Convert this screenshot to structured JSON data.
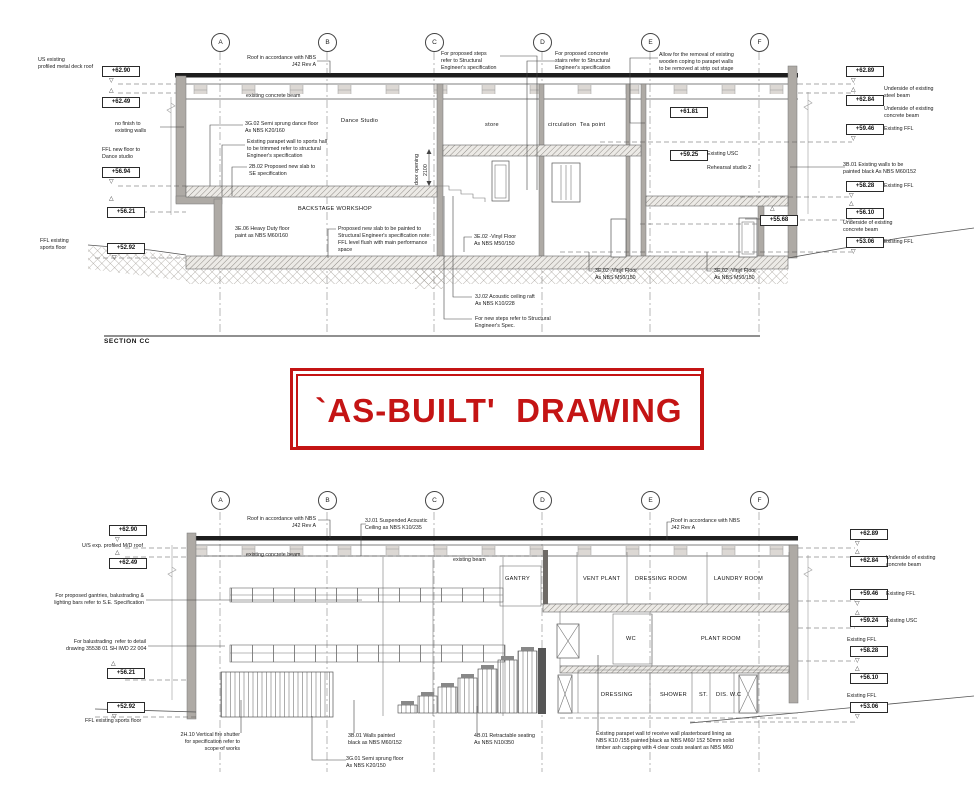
{
  "stamp": {
    "text": "`AS-BUILT'  DRAWING"
  },
  "colors": {
    "stamp_red": "#c41414",
    "line_dark": "#333333",
    "wall_gray": "#aeaaa5"
  },
  "icons": {
    "level-marker-down": "▽",
    "level-marker-up": "△"
  },
  "section_top": {
    "title": "SECTION CC",
    "grid": [
      {
        "label": "A",
        "x": 220
      },
      {
        "label": "B",
        "x": 327
      },
      {
        "label": "C",
        "x": 434
      },
      {
        "label": "D",
        "x": 542
      },
      {
        "label": "E",
        "x": 650
      },
      {
        "label": "F",
        "x": 759
      }
    ],
    "labels": [
      {
        "name": "note-us-existing-roof",
        "cls": "note",
        "text": "US existing\nprofiled metal deck roof",
        "x": 38,
        "y": 57
      },
      {
        "name": "level-box",
        "cls": "box",
        "text": "+62.90",
        "x": 102,
        "y": 66
      },
      {
        "name": "level-marker-down-icon",
        "cls": "marker",
        "text": "▽",
        "x": 109,
        "y": 78
      },
      {
        "name": "level-marker-up-icon",
        "cls": "marker",
        "text": "△",
        "x": 109,
        "y": 88
      },
      {
        "name": "level-box",
        "cls": "box",
        "text": "+62.49",
        "x": 102,
        "y": 97
      },
      {
        "name": "note-no-finish",
        "cls": "note",
        "text": "no finish to\nexisting walls",
        "x": 115,
        "y": 121
      },
      {
        "name": "note-ffl-new-floor",
        "cls": "note",
        "text": "FFL new floor to\nDance studio",
        "x": 102,
        "y": 147
      },
      {
        "name": "level-box",
        "cls": "box",
        "text": "+56.94",
        "x": 102,
        "y": 167
      },
      {
        "name": "level-marker-down-icon",
        "cls": "marker",
        "text": "▽",
        "x": 109,
        "y": 179
      },
      {
        "name": "level-marker-up-icon",
        "cls": "marker",
        "text": "△",
        "x": 109,
        "y": 196
      },
      {
        "name": "level-box",
        "cls": "box",
        "text": "+56.21",
        "x": 107,
        "y": 207
      },
      {
        "name": "note-ffl-existing-sports",
        "cls": "note",
        "text": "FFL existing\nsports floor",
        "x": 40,
        "y": 238
      },
      {
        "name": "level-box",
        "cls": "box",
        "text": "+52.92",
        "x": 107,
        "y": 243
      },
      {
        "name": "level-marker-down-icon",
        "cls": "marker",
        "text": "▽",
        "x": 112,
        "y": 255
      },
      {
        "name": "note-roof-nbs",
        "cls": "note",
        "text": "Roof in accordance with NBS\nJ42 Rev A",
        "x": 241,
        "y": 55,
        "w": 75,
        "align": "right"
      },
      {
        "name": "note-existing-concrete-beam",
        "cls": "note",
        "text": "existing concrete beam",
        "x": 246,
        "y": 93
      },
      {
        "name": "note-dance-floor-spec",
        "cls": "note",
        "text": "3G.02 Semi sprung dance floor\nAs NBS K20/160",
        "x": 245,
        "y": 121
      },
      {
        "name": "note-parapet-wall",
        "cls": "note",
        "text": "Existing parapet wall to sports hall\nto be trimmed refer to structural\nEngineer's specification",
        "x": 247,
        "y": 139
      },
      {
        "name": "note-new-slab",
        "cls": "note",
        "text": "2B.02 Proposed new slab to\nSE specification",
        "x": 249,
        "y": 164
      },
      {
        "name": "room-dance-studio",
        "cls": "room",
        "text": "Dance Studio",
        "x": 341,
        "y": 118
      },
      {
        "name": "note-proposed-steps",
        "cls": "note",
        "text": "For proposed steps\nrefer to Structural\nEngineer's specification",
        "x": 441,
        "y": 51
      },
      {
        "name": "note-proposed-stairs",
        "cls": "note",
        "text": "For proposed concrete\nstairs refer to Structural\nEngineer's specification",
        "x": 555,
        "y": 51
      },
      {
        "name": "note-wooden-coping",
        "cls": "note",
        "text": "Allow for the removal of existing\nwooden coping to parapet walls\nto be removed at strip out stage",
        "x": 659,
        "y": 52
      },
      {
        "name": "room-store",
        "cls": "room",
        "text": "store",
        "x": 485,
        "y": 122
      },
      {
        "name": "room-circulation",
        "cls": "room",
        "text": "circulation",
        "x": 548,
        "y": 122
      },
      {
        "name": "room-tea-point",
        "cls": "room",
        "text": "Tea point",
        "x": 580,
        "y": 122
      },
      {
        "name": "note-door-opening",
        "cls": "rot",
        "text": "door opening",
        "x": 414,
        "y": 185
      },
      {
        "name": "dim-door-opening",
        "cls": "rot",
        "text": "2100",
        "x": 423,
        "y": 176
      },
      {
        "name": "level-box",
        "cls": "box",
        "text": "+61.81",
        "x": 670,
        "y": 107
      },
      {
        "name": "level-box",
        "cls": "box",
        "text": "+59.25",
        "x": 670,
        "y": 150
      },
      {
        "name": "note-existing-usc",
        "cls": "note",
        "text": "Existing USC",
        "x": 707,
        "y": 151
      },
      {
        "name": "room-rehearsal-studio-2",
        "cls": "note",
        "text": "Rehearsal studio 2",
        "x": 707,
        "y": 165
      },
      {
        "name": "room-backstage-workshop",
        "cls": "room",
        "text": "BACKSTAGE WORKSHOP",
        "x": 298,
        "y": 206
      },
      {
        "name": "note-heavy-duty-floor",
        "cls": "note",
        "text": "3E.06 Heavy Duty floor\npaint as NBS M60/160",
        "x": 235,
        "y": 226
      },
      {
        "name": "note-slab-painted",
        "cls": "note",
        "text": "Proposed new slab to be painted to\nStructural Engineer's specification note:\nFFL level flush with main performance\nspace",
        "x": 338,
        "y": 226
      },
      {
        "name": "note-vinyl-floor-1",
        "cls": "note",
        "text": "3E.02 -Vinyl Floor\nAs NBS M50/150",
        "x": 474,
        "y": 234
      },
      {
        "name": "note-vinyl-floor-2",
        "cls": "note",
        "text": "3E.02 -Vinyl Floor\nAs NBS M50/150",
        "x": 595,
        "y": 268
      },
      {
        "name": "note-vinyl-floor-3",
        "cls": "note",
        "text": "3E.02 -Vinyl Floor\nAs NBS M50/150",
        "x": 714,
        "y": 268
      },
      {
        "name": "note-acoustic-raft",
        "cls": "note",
        "text": "3J.02 Acoustic ceiling raft\nAs NBS K10/228",
        "x": 475,
        "y": 294
      },
      {
        "name": "note-new-steps",
        "cls": "note",
        "text": "For new steps refer to Structural\nEngineer's Spec.",
        "x": 475,
        "y": 316
      },
      {
        "name": "section-title",
        "cls": "title",
        "text": "SECTION CC",
        "x": 104,
        "y": 338
      },
      {
        "name": "level-marker-up-icon",
        "cls": "marker",
        "text": "△",
        "x": 770,
        "y": 206
      },
      {
        "name": "level-box",
        "cls": "box",
        "text": "+55.68",
        "x": 760,
        "y": 215
      },
      {
        "name": "level-box",
        "cls": "box",
        "text": "+62.89",
        "x": 846,
        "y": 66
      },
      {
        "name": "level-marker-down-icon",
        "cls": "marker",
        "text": "▽",
        "x": 851,
        "y": 78
      },
      {
        "name": "level-marker-up-icon",
        "cls": "marker",
        "text": "△",
        "x": 851,
        "y": 87
      },
      {
        "name": "level-box",
        "cls": "box",
        "text": "+62.84",
        "x": 846,
        "y": 95
      },
      {
        "name": "note-underside-steel",
        "cls": "note",
        "text": "Underside of existing\nsteel beam",
        "x": 884,
        "y": 86
      },
      {
        "name": "note-underside-concrete",
        "cls": "note",
        "text": "Underside of existing\nconcrete beam",
        "x": 884,
        "y": 106
      },
      {
        "name": "level-box",
        "cls": "box",
        "text": "+59.46",
        "x": 846,
        "y": 124
      },
      {
        "name": "note-existing-ffl",
        "cls": "note",
        "text": "Existing FFL",
        "x": 884,
        "y": 126
      },
      {
        "name": "level-marker-down-icon",
        "cls": "marker",
        "text": "▽",
        "x": 851,
        "y": 136
      },
      {
        "name": "note-walls-painted-black",
        "cls": "note",
        "text": "3B.01 Existing walls to be\npainted black As NBS M60/152",
        "x": 843,
        "y": 162
      },
      {
        "name": "level-box",
        "cls": "box",
        "text": "+58.28",
        "x": 846,
        "y": 181
      },
      {
        "name": "note-existing-ffl",
        "cls": "note",
        "text": "Existing FFL",
        "x": 884,
        "y": 183
      },
      {
        "name": "level-marker-down-icon",
        "cls": "marker",
        "text": "▽",
        "x": 849,
        "y": 193
      },
      {
        "name": "level-marker-up-icon",
        "cls": "marker",
        "text": "△",
        "x": 849,
        "y": 201
      },
      {
        "name": "level-box",
        "cls": "box",
        "text": "+56.10",
        "x": 846,
        "y": 208
      },
      {
        "name": "note-underside-concrete",
        "cls": "note",
        "text": "Underside of existing\nconcrete beam",
        "x": 843,
        "y": 220
      },
      {
        "name": "level-box",
        "cls": "box",
        "text": "+53.06",
        "x": 846,
        "y": 237
      },
      {
        "name": "note-existing-ffl",
        "cls": "note",
        "text": "Existing FFL",
        "x": 884,
        "y": 239
      },
      {
        "name": "level-marker-down-icon",
        "cls": "marker",
        "text": "▽",
        "x": 851,
        "y": 249
      }
    ]
  },
  "section_bottom": {
    "grid": [
      {
        "label": "A",
        "x": 220
      },
      {
        "label": "B",
        "x": 327
      },
      {
        "label": "C",
        "x": 434
      },
      {
        "label": "D",
        "x": 542
      },
      {
        "label": "E",
        "x": 650
      },
      {
        "label": "F",
        "x": 759
      }
    ],
    "labels": [
      {
        "name": "level-box",
        "cls": "box",
        "text": "+62.90",
        "x": 109,
        "y": 525
      },
      {
        "name": "level-marker-down-icon",
        "cls": "marker",
        "text": "▽",
        "x": 115,
        "y": 537
      },
      {
        "name": "note-us-exp-roof",
        "cls": "note",
        "text": "U/S exp. profiled M/D roof",
        "x": 82,
        "y": 543
      },
      {
        "name": "level-marker-up-icon",
        "cls": "marker",
        "text": "△",
        "x": 115,
        "y": 550
      },
      {
        "name": "level-box",
        "cls": "box",
        "text": "+62.49",
        "x": 109,
        "y": 558
      },
      {
        "name": "note-gantries",
        "cls": "note",
        "text": "For proposed gantries, balustrading &\nlighting bars refer to S.E. Specification",
        "x": 52,
        "y": 593,
        "w": 92,
        "align": "right"
      },
      {
        "name": "note-balustrading",
        "cls": "note",
        "text": "For balustrading  refer to detail\ndrawing 35538 01 SH IWD 22 004",
        "x": 66,
        "y": 639,
        "w": 80,
        "align": "right"
      },
      {
        "name": "level-marker-up-icon",
        "cls": "marker",
        "text": "△",
        "x": 111,
        "y": 661
      },
      {
        "name": "level-box",
        "cls": "box",
        "text": "+56.21",
        "x": 107,
        "y": 668
      },
      {
        "name": "level-box",
        "cls": "box",
        "text": "+52.92",
        "x": 107,
        "y": 702
      },
      {
        "name": "level-marker-down-icon",
        "cls": "marker",
        "text": "▽",
        "x": 112,
        "y": 714
      },
      {
        "name": "note-ffl-existing-sports",
        "cls": "note",
        "text": "FFL existing sports floor",
        "x": 85,
        "y": 718
      },
      {
        "name": "note-fire-shutter",
        "cls": "note",
        "text": "2H.10 Vertical fire shutter\nfor specification refer to\nscope of works",
        "x": 152,
        "y": 732,
        "w": 88,
        "align": "right"
      },
      {
        "name": "note-roof-nbs",
        "cls": "note",
        "text": "Roof in accordance with NBS\nJ42 Rev A",
        "x": 241,
        "y": 516,
        "w": 75,
        "align": "right"
      },
      {
        "name": "note-suspended-ceiling",
        "cls": "note",
        "text": "3J.01 Suspended Acoustic\nCeiling as NBS K10/235",
        "x": 365,
        "y": 518
      },
      {
        "name": "note-roof-nbs",
        "cls": "note",
        "text": "Roof in accordance with NBS\nJ42 Rev A",
        "x": 671,
        "y": 518
      },
      {
        "name": "note-existing-concrete-beam",
        "cls": "note",
        "text": "existing concrete beam",
        "x": 246,
        "y": 552
      },
      {
        "name": "note-existing-beam",
        "cls": "note",
        "text": "existing beam",
        "x": 453,
        "y": 557
      },
      {
        "name": "room-gantry",
        "cls": "room",
        "text": "GANTRY",
        "x": 505,
        "y": 576
      },
      {
        "name": "room-vent-plant",
        "cls": "room",
        "text": "VENT PLANT",
        "x": 583,
        "y": 576
      },
      {
        "name": "room-dressing-room",
        "cls": "room",
        "text": "DRESSING ROOM",
        "x": 635,
        "y": 576
      },
      {
        "name": "room-laundry-room",
        "cls": "room",
        "text": "LAUNDRY ROOM",
        "x": 714,
        "y": 576
      },
      {
        "name": "room-wc",
        "cls": "room",
        "text": "WC",
        "x": 626,
        "y": 636
      },
      {
        "name": "room-plant-room",
        "cls": "room",
        "text": "PLANT ROOM",
        "x": 701,
        "y": 636
      },
      {
        "name": "room-dressing",
        "cls": "room",
        "text": "DRESSING",
        "x": 601,
        "y": 692
      },
      {
        "name": "room-shower",
        "cls": "room",
        "text": "SHOWER",
        "x": 660,
        "y": 692
      },
      {
        "name": "room-st",
        "cls": "room",
        "text": "ST.",
        "x": 699,
        "y": 692
      },
      {
        "name": "room-dis-wc",
        "cls": "room",
        "text": "DIS. W.C",
        "x": 716,
        "y": 692
      },
      {
        "name": "note-walls-painted",
        "cls": "note",
        "text": "3B.01 Walls painted\nblack as NBS M60/152",
        "x": 348,
        "y": 733
      },
      {
        "name": "note-semi-sprung-floor",
        "cls": "note",
        "text": "3G.01 Semi sprung floor\nAs NBS K20/150",
        "x": 346,
        "y": 756
      },
      {
        "name": "note-retractable-seating",
        "cls": "note",
        "text": "4B.01 Retractable seating\nAs NBS N10/350",
        "x": 474,
        "y": 733
      },
      {
        "name": "note-parapet-lining",
        "cls": "note",
        "text": "Existing parapet wall to receive wall plasterboard lining as\nNBS K10 /155 painted black as NBS M60/ 152 50mm solid\ntimber ash capping with 4 clear coats sealant as NBS M60",
        "x": 596,
        "y": 731
      },
      {
        "name": "level-box",
        "cls": "box",
        "text": "+62.89",
        "x": 850,
        "y": 529
      },
      {
        "name": "level-marker-down-icon",
        "cls": "marker",
        "text": "▽",
        "x": 855,
        "y": 541
      },
      {
        "name": "level-marker-up-icon",
        "cls": "marker",
        "text": "△",
        "x": 855,
        "y": 549
      },
      {
        "name": "level-box",
        "cls": "box",
        "text": "+62.84",
        "x": 850,
        "y": 556
      },
      {
        "name": "note-underside-concrete",
        "cls": "note",
        "text": "Underside of existing\nconcrete beam",
        "x": 886,
        "y": 555
      },
      {
        "name": "level-box",
        "cls": "box",
        "text": "+59.46",
        "x": 850,
        "y": 589
      },
      {
        "name": "note-existing-ffl",
        "cls": "note",
        "text": "Existing FFL",
        "x": 886,
        "y": 591
      },
      {
        "name": "level-marker-down-icon",
        "cls": "marker",
        "text": "▽",
        "x": 855,
        "y": 601
      },
      {
        "name": "level-marker-up-icon",
        "cls": "marker",
        "text": "△",
        "x": 855,
        "y": 610
      },
      {
        "name": "level-box",
        "cls": "box",
        "text": "+59.24",
        "x": 850,
        "y": 616
      },
      {
        "name": "note-existing-usc",
        "cls": "note",
        "text": "Existing USC",
        "x": 886,
        "y": 618
      },
      {
        "name": "note-existing-ffl",
        "cls": "note",
        "text": "Existing FFL",
        "x": 847,
        "y": 637
      },
      {
        "name": "level-box",
        "cls": "box",
        "text": "+58.28",
        "x": 850,
        "y": 646
      },
      {
        "name": "level-marker-down-icon",
        "cls": "marker",
        "text": "▽",
        "x": 855,
        "y": 658
      },
      {
        "name": "level-marker-up-icon",
        "cls": "marker",
        "text": "△",
        "x": 855,
        "y": 666
      },
      {
        "name": "level-box",
        "cls": "box",
        "text": "+56.10",
        "x": 850,
        "y": 673
      },
      {
        "name": "note-existing-ffl",
        "cls": "note",
        "text": "Existing FFL",
        "x": 847,
        "y": 693
      },
      {
        "name": "level-box",
        "cls": "box",
        "text": "+53.06",
        "x": 850,
        "y": 702
      },
      {
        "name": "level-marker-down-icon",
        "cls": "marker",
        "text": "▽",
        "x": 855,
        "y": 714
      }
    ]
  }
}
